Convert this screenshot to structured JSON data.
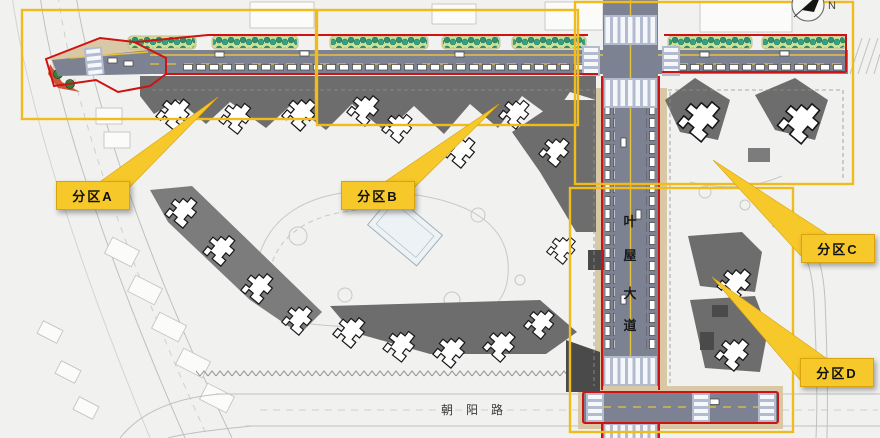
{
  "title": "residential-district-master-plan",
  "zones": {
    "a": {
      "label": "分区A"
    },
    "b": {
      "label": "分区B"
    },
    "c": {
      "label": "分区C"
    },
    "d": {
      "label": "分区D"
    }
  },
  "roads": {
    "east_avenue": {
      "name": "叶屋大道",
      "chars": [
        "叶",
        "屋",
        "大",
        "道"
      ]
    },
    "south_road": {
      "name": "朝阳路",
      "chars": [
        "朝",
        "阳",
        "路"
      ]
    }
  },
  "compass": {
    "north_label": "N"
  },
  "colors": {
    "zone_outline": "#f0bb1c",
    "label_bg": "#f7c82a",
    "label_border": "#d9a30e",
    "boundary_red": "#cf1212",
    "road_gray": "#7d8292",
    "center_yellow": "#e9c23c",
    "pavement_tan": "#d8c8a6",
    "planting_teal": "#2e8f74",
    "planting_bg": "#cbe295",
    "building_gray": "#6d6d6d",
    "crosswalk_blue": "#b3bccf",
    "text_dark": "#17181c"
  }
}
